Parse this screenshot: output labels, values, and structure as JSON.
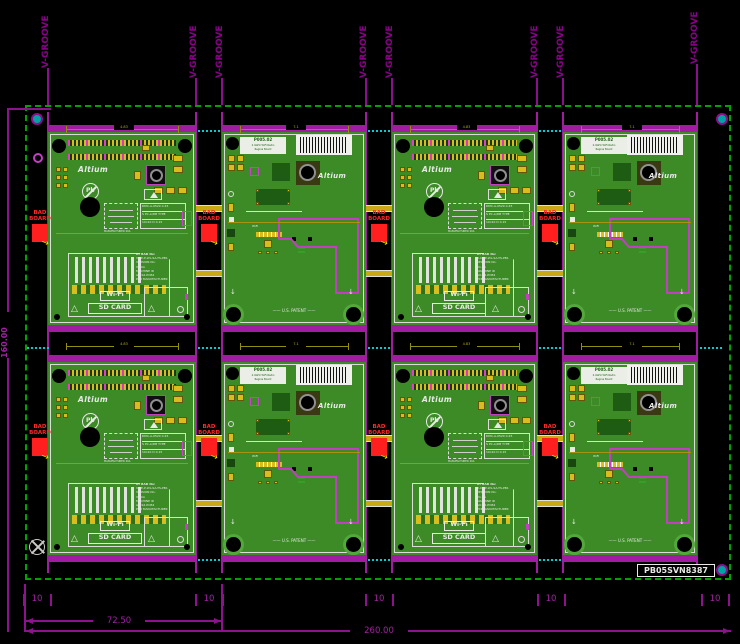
{
  "panel": {
    "serial": "PB05SVN8387"
  },
  "labels": {
    "v_groove": "V-GROOVE",
    "bad1": "BAD",
    "bad2": "BOARD"
  },
  "dims": {
    "total": "260.00",
    "sub": "72.50",
    "height": "160.00",
    "rail": "10",
    "d1": "4.83",
    "d2": "7.1"
  },
  "board_a": {
    "logo": "Altium",
    "pb": "Pb",
    "wifi": "Wi-Fi",
    "sd": "SD CARD",
    "info": [
      "AT BAD No:",
      "V-CE-P-WL-SA-TS-PB1",
      "VERSION No:",
      "V1.0A",
      "MACHINE ID",
      "AO-S2-PCB4",
      "PCB MANUFACTURER"
    ],
    "mfg_note": "MANUFACTURED 20A",
    "table": [
      "DMC-A-0520   0.45",
      "S PC-A/DB  TYPE",
      "10x10 D   0.15"
    ]
  },
  "board_b": {
    "title": "P005.02",
    "sub1": "2.4GHz WiFi Radio",
    "sub2": "Regina Board",
    "logo": "Altium",
    "ant": "WiFi",
    "patent": "—— U.S. PATENT ——"
  }
}
